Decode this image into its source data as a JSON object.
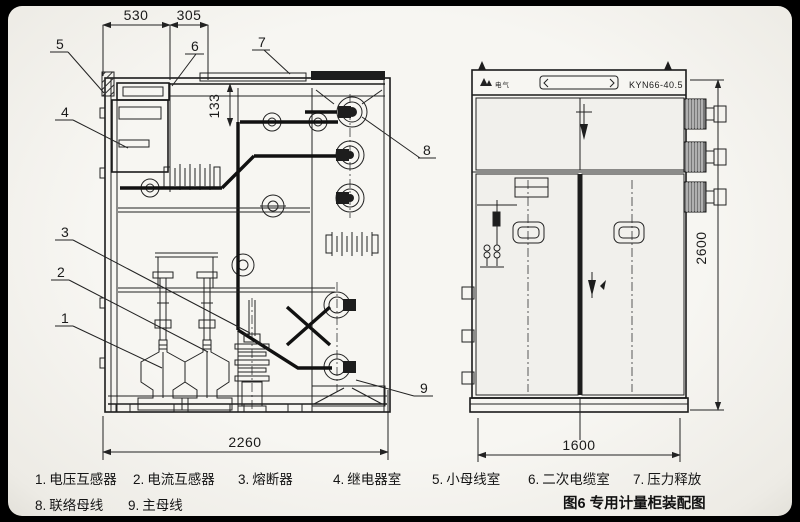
{
  "figure": {
    "caption": "图6 专用计量柜装配图",
    "model": "KYN66-40.5",
    "brand": "电气"
  },
  "dimensions": {
    "top_left_width": "530",
    "top_right_width": "305",
    "inner_height": "133",
    "side_view_width": "2260",
    "front_view_width": "1600",
    "front_view_height": "2600"
  },
  "callouts": {
    "c1": "1",
    "c2": "2",
    "c3": "3",
    "c4": "4",
    "c5": "5",
    "c6": "6",
    "c7": "7",
    "c8": "8",
    "c9": "9"
  },
  "legend": {
    "row1": [
      {
        "num": "1.",
        "label": "电压互感器"
      },
      {
        "num": "2.",
        "label": "电流互感器"
      },
      {
        "num": "3.",
        "label": "熔断器"
      },
      {
        "num": "4.",
        "label": "继电器室"
      },
      {
        "num": "5.",
        "label": "小母线室"
      },
      {
        "num": "6.",
        "label": "二次电缆室"
      },
      {
        "num": "7.",
        "label": "压力释放"
      }
    ],
    "row2": [
      {
        "num": "8.",
        "label": "联络母线"
      },
      {
        "num": "9.",
        "label": "主母线"
      }
    ]
  },
  "colors": {
    "line": "#1b1b1b",
    "paper": "#f5f4f0",
    "dark_fill": "#1d1d1d"
  }
}
